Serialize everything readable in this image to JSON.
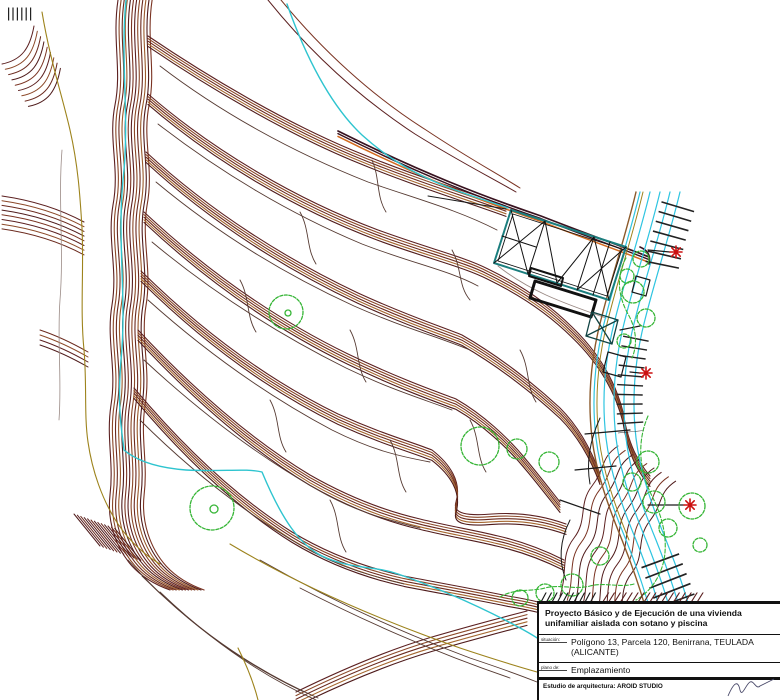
{
  "page": {
    "background": "#ffffff",
    "kind": "architectural site / topographic location plan"
  },
  "title_block": {
    "project_title": "Proyecto Básico y de Ejecución de una vivienda unifamiliar aislada con sotano y piscina",
    "fields": [
      {
        "label": "situación:",
        "value": "Polígono 13, Parcela 120, Benirrana, TEULADA (ALICANTE)"
      },
      {
        "label": "plano de:",
        "value": "Emplazamiento"
      }
    ],
    "studio_line": "Estudio de arquitectura: AROID STUDIO"
  },
  "drawing": {
    "icons": [
      "star-marker",
      "tree-symbol",
      "retaining-wall-ticks"
    ],
    "marker_count": 3,
    "colors": {
      "contour_dark": "#5C2020",
      "contour_brown": "#8B4828",
      "contour_tan": "#A5672F",
      "contour_deep": "#4F1B1B",
      "water_cyan": "#2EC4CF",
      "vegetation_green": "#35B535",
      "marker_red": "#CC1111",
      "building_outline_teal": "#1B7E7E",
      "boundary_olive": "#9D831C",
      "detail_black": "#1A1A1A",
      "accent_orange": "#D2691E",
      "dark_purple": "#38121F"
    }
  }
}
